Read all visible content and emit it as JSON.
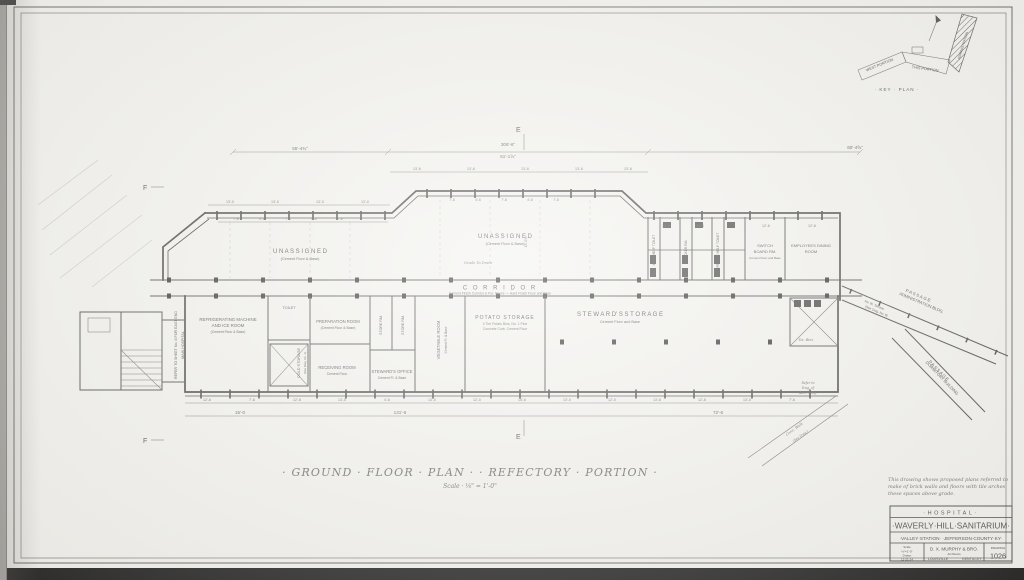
{
  "title": {
    "main": "· GROUND · FLOOR · PLAN ·    · REFECTORY · PORTION ·",
    "scale": "Scale · ⅛\" = 1'-0\""
  },
  "key_plan": {
    "caption": "· KEY · PLAN ·",
    "west": "WEST   PORTION",
    "center": "THIS  PORTION",
    "admin": "ADMINISTRATION"
  },
  "note": {
    "line1": "This drawing shows proposed plans referred to",
    "line2": "make of brick walls and floors with tile arches",
    "line3": "these spaces above grade."
  },
  "rooms": {
    "unassigned": "U N A S S I G N E D",
    "cement_floor_base": "(Cement Floor & Base)",
    "corridor": "C O R R I D O R",
    "corridor_note": "Cement Finish Corridor & Por. Floors — Hard Finish Floor and Base",
    "grade_note": "Grade To Drain",
    "refrigerating_1": "REFRIGERATING MACHINE",
    "refrigerating_2": "AND ICE ROOM",
    "toilet": "TOILET",
    "cold_storage": "COLD STORAGE",
    "see_dwg": "(See Dwg. No. 4)",
    "preparation": "PREPARATION ROOM",
    "receiving": "RECEIVING ROOM",
    "cement_floor": "Cement Floor",
    "steward_office": "STEWARD'S OFFICE",
    "store_rm": "STORE RM.",
    "vegetable": "VEGETABLE ROOM",
    "cement_fl_base": "Cement Fl. & Base",
    "potato": "POTATO STORAGE",
    "potato_note1": "4 Tier Potato Bins, No. 1 Pine",
    "potato_note2": "Concrete Curb, Cement Floor",
    "steward_storage": "S T E W A R D' S     S T O R A G E",
    "cement_floor_and_base": "Cement Floor and Base",
    "male_toilet": "MALE HELP TOILET",
    "locker": "LOCKER RM.",
    "female_toilet": "FEMALE HELP TOILET",
    "switch_1": "SWITCH",
    "switch_2": "BOARD RM.",
    "dining_1": "EMPLOYEES DINING",
    "dining_2": "ROOM",
    "bins": "Da. Bins",
    "refer_adm_1": "Refer to",
    "refer_adm_2": "Dwg. of",
    "refer_adm_3": "Adm. Bldg.",
    "terrace_1": "No. W. Terrace",
    "terrace_2": "(See Dwg. No. 8)",
    "passage": "PASSAGE",
    "admin_bldg": "ADMINISTRATION BLDG.",
    "dormitory_bldg": "DORMITORY BUILDING",
    "walk_1": "Conc. Walk",
    "walk_2": "(See Dwg.)",
    "refer_sheet": "REFER TO SHEET No. 8 FOR EAST END",
    "main_hospital": "MAIN HOSPITAL"
  },
  "markers": {
    "f": "F",
    "e": "E"
  },
  "dims": {
    "total_left": "55'-4¾\"",
    "total_mid": "306'-6\"",
    "total_right": "60'-4⅝\"",
    "sub_total": "61'-1⅞\"",
    "bay_13_6": "13'-6",
    "bay_13_0": "13'-0",
    "bay_12_6": "12'-6",
    "bay_12_0": "12'-0",
    "bay_15_0": "15'-0",
    "bay_15_6": "15'-6",
    "bay_7_6": "7'-6",
    "bay_7_8": "7'-8",
    "bay_4_6": "4'-6",
    "total_bottom_left": "131'-6",
    "total_bottom_right": "72'-6",
    "vert": "15'-0⅝"
  },
  "title_block": {
    "hospital": "·HOSPITAL·",
    "name": "·WAVERLY·HILL·SANITARIUM·",
    "location": "·VALLEY·STATION·  ·JEFFERSON·COUNTY·KY·",
    "meta1": "Scale",
    "meta2": "⅛\"=1'-0\"",
    "meta3": "Drawn",
    "meta4": "12-21-24",
    "architect": "D. X. MURPHY & BRO.",
    "architect_sub": "Architects",
    "city": "LOUISVILLE",
    "state": "KENTUCKY",
    "sheet_label": "DRAWING",
    "sheet_number": "1026"
  },
  "colors": {
    "ink": "#3a3a3a",
    "paper": "#f2f1ed"
  }
}
